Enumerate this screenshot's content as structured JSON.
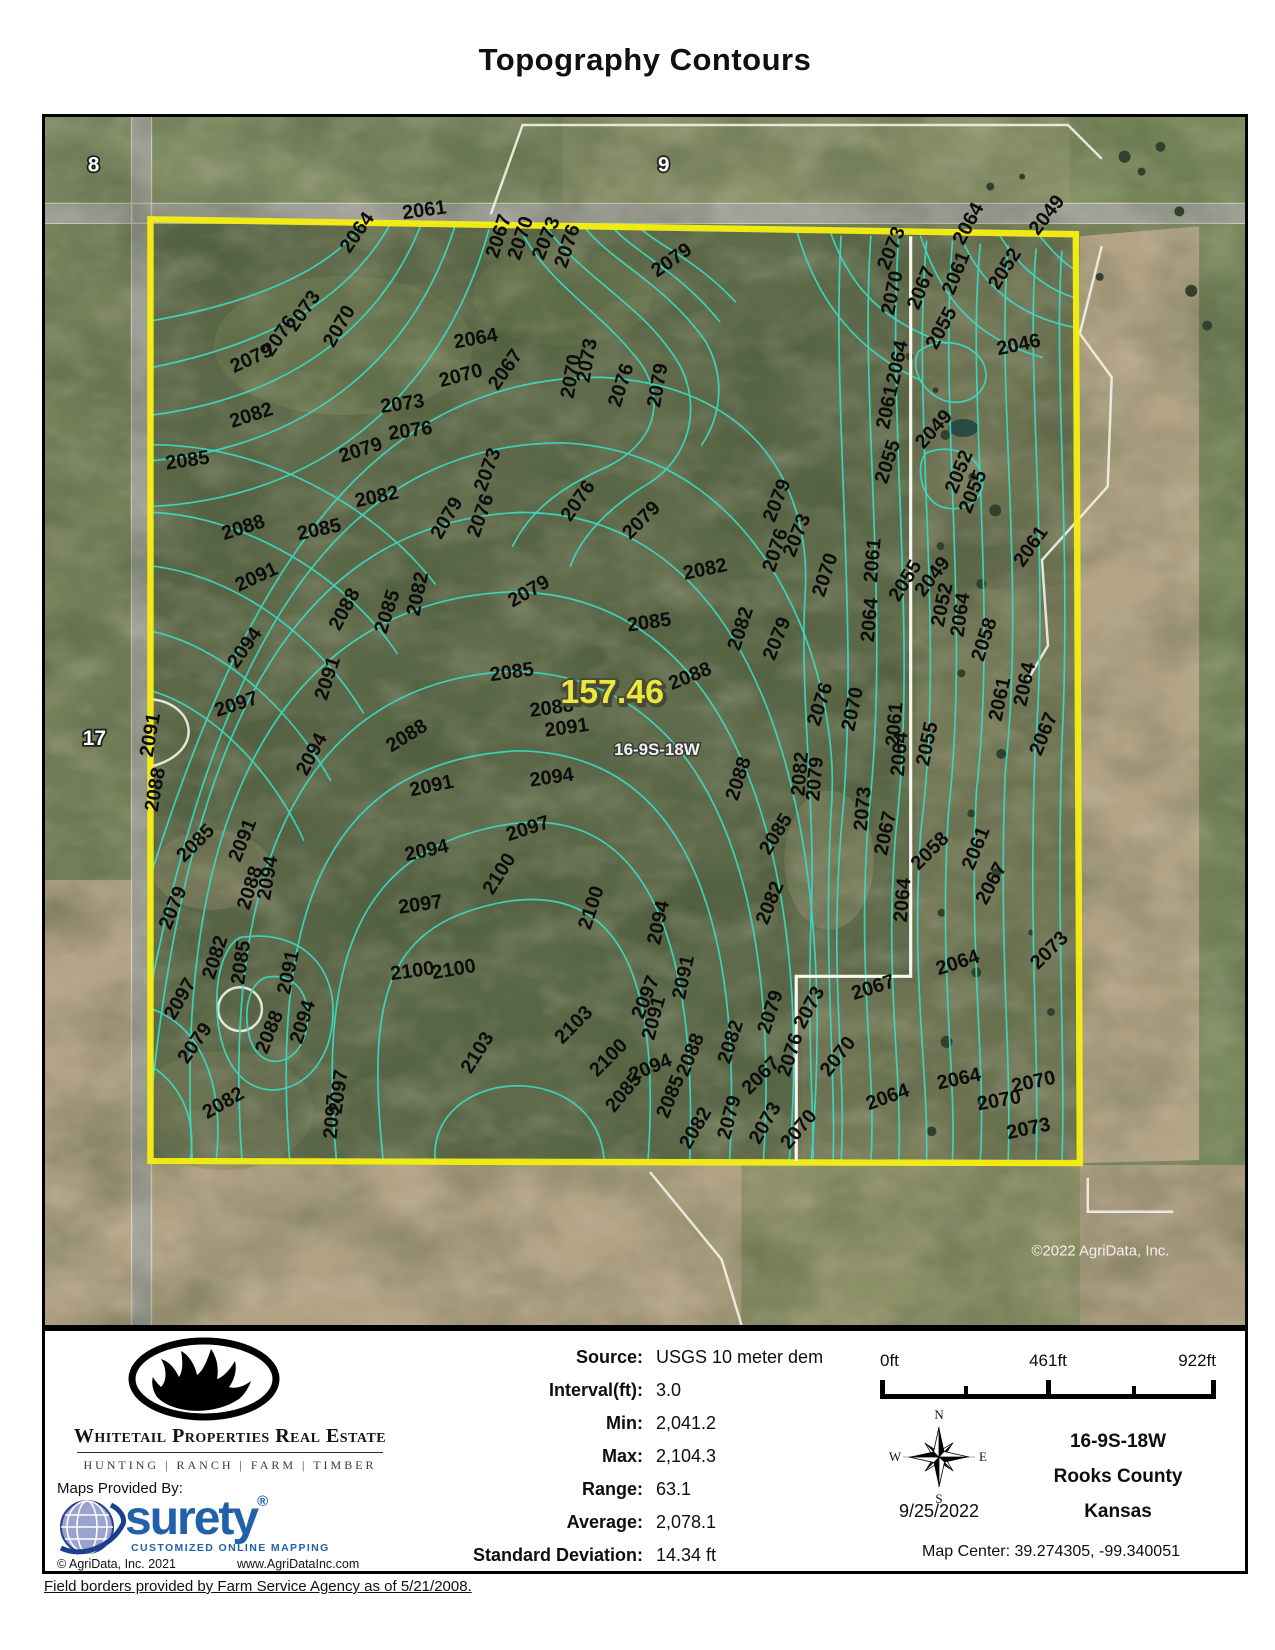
{
  "title": "Topography Contours",
  "map": {
    "acreage": "157.46",
    "parcel_label": "16-9S-18W",
    "sections": [
      "8",
      "9",
      "17"
    ],
    "copyright": "©2022 AgriData, Inc.",
    "colors": {
      "boundary": "#f7ef13",
      "contour": "#3bd8c0",
      "acreage_text": "#ece73e",
      "surety_blue": "#2161ab"
    },
    "contour_paths": [
      "M320,106 C290,150 220,185 108,205",
      "M348,106 C310,175 240,225 108,252",
      "M378,108 C340,205 255,280 108,300",
      "M412,110 C372,235 275,330 108,346",
      "M446,114 C405,262 295,382 108,392",
      "M476,110 C505,170 560,195 600,250 C625,290 610,330 565,352 C520,372 488,395 470,432",
      "M502,108 C538,162 602,188 638,250 C660,292 648,342 608,368 C568,392 540,420 528,452",
      "M540,108 C568,146 622,166 664,226 C684,262 680,300 660,330",
      "M566,106 C590,136 636,153 678,206",
      "M592,106 C612,128 652,141 694,186",
      "M108,330 C220,330 330,390 392,470",
      "M108,398 C200,402 300,460 354,540",
      "M108,452 C190,462 272,520 320,600",
      "M108,518 C175,532 245,592 287,668",
      "M108,578 C165,595 227,655 260,728",
      "M392,1051 C385,955 555,945 562,1051",
      "M340,1051 C322,880 345,812 462,790 C585,770 618,880 606,1051",
      "M293,1051 C272,832 325,735 465,712 C615,690 655,852 648,1051",
      "M246,1051 C225,780 295,648 475,638 C658,640 700,835 688,1051",
      "M198,1051 C176,742 268,568 468,558 C682,560 738,802 722,1051",
      "M148,1051 C128,702 238,488 468,478 C700,478 772,762 748,1051",
      "M108,975 C148,602 258,408 478,398 C718,398 800,702 770,1051",
      "M108,868 C178,522 298,330 518,328 C725,335 802,560 790,700 C782,850 795,960 792,1051",
      "M108,758 C208,440 338,262 558,262 C720,270 770,380 764,480 C758,580 775,700 770,800 C766,920 772,990 772,1051",
      "M196,826 C258,816 298,858 288,918 C278,980 218,998 190,958 C164,922 168,840 196,826",
      "M222,866 C254,860 270,888 262,922 C252,958 216,960 206,928 C198,898 206,872 222,866",
      "M108,898 C160,918 180,978 172,1051",
      "M108,956 C140,978 152,1012 146,1051",
      "M800,120 C790,300 820,520 800,720 C788,870 806,960 800,1051",
      "M830,120 C818,280 850,500 828,700 C815,860 836,960 830,1051",
      "M858,120 C845,300 878,520 855,720 C843,870 862,960 858,1051",
      "M886,125 C870,300 906,520 880,720 C870,870 888,960 886,1051",
      "M912,125 C898,300 930,500 908,700 C898,860 916,960 912,1051",
      "M940,128 C925,280 958,480 936,680 C928,850 946,950 940,1051",
      "M968,130 C955,280 986,460 965,660 C958,840 972,950 968,1051",
      "M996,133 C985,260 1010,440 995,640 C988,830 1000,950 996,1051",
      "M1022,135 C1013,250 1032,430 1022,630 C1016,820 1026,950 1022,1051",
      "M790,118 C810,172 842,206 906,228",
      "M756,116 C776,186 816,236 882,266",
      "M880,120 C900,180 932,222 1002,242",
      "M920,120 C942,172 982,202 1036,212",
      "M960,120 C982,156 1012,176 1036,182",
      "M1000,120 C1016,140 1028,150 1036,154",
      "M878,236 C898,220 934,226 944,250 C952,274 930,292 906,286 C884,280 868,254 878,236",
      "M886,338 C910,328 938,340 942,362 C946,386 922,400 900,392 C880,384 874,350 886,338"
    ],
    "contour_labels": [
      {
        "t": "2061",
        "x": 360,
        "y": 103,
        "r": -8
      },
      {
        "t": "2064",
        "x": 306,
        "y": 138,
        "r": -55
      },
      {
        "t": "2067",
        "x": 455,
        "y": 143,
        "r": -72
      },
      {
        "t": "2070",
        "x": 477,
        "y": 145,
        "r": -72
      },
      {
        "t": "2073",
        "x": 501,
        "y": 145,
        "r": -68
      },
      {
        "t": "2076",
        "x": 524,
        "y": 153,
        "r": -72
      },
      {
        "t": "2079",
        "x": 615,
        "y": 162,
        "r": -35
      },
      {
        "t": "2073",
        "x": 252,
        "y": 217,
        "r": -55
      },
      {
        "t": "2076",
        "x": 228,
        "y": 242,
        "r": -55
      },
      {
        "t": "2079",
        "x": 190,
        "y": 258,
        "r": -25
      },
      {
        "t": "2070",
        "x": 290,
        "y": 233,
        "r": -60
      },
      {
        "t": "2064",
        "x": 412,
        "y": 233,
        "r": -10
      },
      {
        "t": "2070",
        "x": 398,
        "y": 272,
        "r": -15
      },
      {
        "t": "2067",
        "x": 455,
        "y": 276,
        "r": -55
      },
      {
        "t": "2073",
        "x": 547,
        "y": 268,
        "r": -80
      },
      {
        "t": "2070",
        "x": 531,
        "y": 284,
        "r": -80
      },
      {
        "t": "2076",
        "x": 578,
        "y": 293,
        "r": -72
      },
      {
        "t": "2079",
        "x": 618,
        "y": 293,
        "r": -80
      },
      {
        "t": "2082",
        "x": 188,
        "y": 313,
        "r": -18
      },
      {
        "t": "2073",
        "x": 338,
        "y": 298,
        "r": -8
      },
      {
        "t": "2076",
        "x": 346,
        "y": 325,
        "r": -8
      },
      {
        "t": "2079",
        "x": 298,
        "y": 348,
        "r": -18
      },
      {
        "t": "2085",
        "x": 122,
        "y": 355,
        "r": -8
      },
      {
        "t": "2082",
        "x": 313,
        "y": 393,
        "r": -12
      },
      {
        "t": "2073",
        "x": 443,
        "y": 378,
        "r": -70
      },
      {
        "t": "2076",
        "x": 436,
        "y": 424,
        "r": -70
      },
      {
        "t": "2079",
        "x": 398,
        "y": 426,
        "r": -60
      },
      {
        "t": "2088",
        "x": 180,
        "y": 426,
        "r": -18
      },
      {
        "t": "2085",
        "x": 255,
        "y": 426,
        "r": -12
      },
      {
        "t": "2076",
        "x": 528,
        "y": 408,
        "r": -55
      },
      {
        "t": "2079",
        "x": 588,
        "y": 426,
        "r": -45
      },
      {
        "t": "2091",
        "x": 195,
        "y": 478,
        "r": -25
      },
      {
        "t": "2082",
        "x": 643,
        "y": 466,
        "r": -12
      },
      {
        "t": "2079",
        "x": 470,
        "y": 494,
        "r": -30
      },
      {
        "t": "2085",
        "x": 586,
        "y": 518,
        "r": -8
      },
      {
        "t": "2082",
        "x": 376,
        "y": 503,
        "r": -78
      },
      {
        "t": "2085",
        "x": 343,
        "y": 521,
        "r": -72
      },
      {
        "t": "2088",
        "x": 296,
        "y": 518,
        "r": -62
      },
      {
        "t": "2094",
        "x": 193,
        "y": 556,
        "r": -55
      },
      {
        "t": "2091",
        "x": 283,
        "y": 588,
        "r": -72
      },
      {
        "t": "2097",
        "x": 173,
        "y": 604,
        "r": -18
      },
      {
        "t": "2085",
        "x": 448,
        "y": 568,
        "r": -8
      },
      {
        "t": "2082",
        "x": 698,
        "y": 538,
        "r": -72
      },
      {
        "t": "2088",
        "x": 630,
        "y": 577,
        "r": -22
      },
      {
        "t": "2079",
        "x": 733,
        "y": 548,
        "r": -68
      },
      {
        "t": "2091",
        "x": 108,
        "y": 645,
        "r": -80
      },
      {
        "t": "2088",
        "x": 113,
        "y": 700,
        "r": -80
      },
      {
        "t": "2094",
        "x": 263,
        "y": 664,
        "r": -62
      },
      {
        "t": "2088",
        "x": 348,
        "y": 640,
        "r": -32
      },
      {
        "t": "2091",
        "x": 368,
        "y": 684,
        "r": -12
      },
      {
        "t": "2088",
        "x": 488,
        "y": 604,
        "r": -8
      },
      {
        "t": "2091",
        "x": 503,
        "y": 624,
        "r": -8
      },
      {
        "t": "2094",
        "x": 488,
        "y": 674,
        "r": -8
      },
      {
        "t": "2097",
        "x": 466,
        "y": 729,
        "r": -18
      },
      {
        "t": "2094",
        "x": 363,
        "y": 749,
        "r": -12
      },
      {
        "t": "2100",
        "x": 450,
        "y": 784,
        "r": -58
      },
      {
        "t": "2097",
        "x": 356,
        "y": 802,
        "r": -8
      },
      {
        "t": "2085",
        "x": 140,
        "y": 751,
        "r": -45
      },
      {
        "t": "2091",
        "x": 196,
        "y": 751,
        "r": -68
      },
      {
        "t": "2088",
        "x": 205,
        "y": 799,
        "r": -72
      },
      {
        "t": "2094",
        "x": 226,
        "y": 789,
        "r": -80
      },
      {
        "t": "2079",
        "x": 126,
        "y": 819,
        "r": -68
      },
      {
        "t": "2082",
        "x": 170,
        "y": 869,
        "r": -72
      },
      {
        "t": "2085",
        "x": 200,
        "y": 874,
        "r": -82
      },
      {
        "t": "2091",
        "x": 246,
        "y": 884,
        "r": -78
      },
      {
        "t": "2094",
        "x": 258,
        "y": 934,
        "r": -72
      },
      {
        "t": "2088",
        "x": 223,
        "y": 944,
        "r": -68
      },
      {
        "t": "2079",
        "x": 143,
        "y": 954,
        "r": -55
      },
      {
        "t": "2082",
        "x": 163,
        "y": 1009,
        "r": -30
      },
      {
        "t": "2097",
        "x": 298,
        "y": 1004,
        "r": -82
      },
      {
        "t": "2100",
        "x": 348,
        "y": 869,
        "r": -8
      },
      {
        "t": "2103",
        "x": 428,
        "y": 964,
        "r": -58
      },
      {
        "t": "2100",
        "x": 548,
        "y": 819,
        "r": -72
      },
      {
        "t": "2103",
        "x": 520,
        "y": 934,
        "r": -45
      },
      {
        "t": "2100",
        "x": 555,
        "y": 967,
        "r": -45
      },
      {
        "t": "2094",
        "x": 590,
        "y": 971,
        "r": -22
      },
      {
        "t": "2097",
        "x": 601,
        "y": 909,
        "r": -68
      },
      {
        "t": "2094",
        "x": 618,
        "y": 834,
        "r": -78
      },
      {
        "t": "2091",
        "x": 643,
        "y": 889,
        "r": -78
      },
      {
        "t": "2088",
        "x": 646,
        "y": 967,
        "r": -68
      },
      {
        "t": "2085",
        "x": 626,
        "y": 1009,
        "r": -68
      },
      {
        "t": "2082",
        "x": 688,
        "y": 954,
        "r": -72
      },
      {
        "t": "2088",
        "x": 696,
        "y": 689,
        "r": -72
      },
      {
        "t": "2085",
        "x": 728,
        "y": 744,
        "r": -58
      },
      {
        "t": "2082",
        "x": 726,
        "y": 814,
        "r": -68
      },
      {
        "t": "2079",
        "x": 728,
        "y": 924,
        "r": -72
      },
      {
        "t": "2076",
        "x": 748,
        "y": 967,
        "r": -72
      },
      {
        "t": "2073",
        "x": 763,
        "y": 919,
        "r": -62
      },
      {
        "t": "2070",
        "x": 788,
        "y": 967,
        "r": -52
      },
      {
        "t": "2067",
        "x": 813,
        "y": 889,
        "r": -18
      },
      {
        "t": "2064",
        "x": 898,
        "y": 864,
        "r": -18
      },
      {
        "t": "2064",
        "x": 898,
        "y": 979,
        "r": -12
      },
      {
        "t": "2070",
        "x": 973,
        "y": 982,
        "r": -12
      },
      {
        "t": "2073",
        "x": 998,
        "y": 859,
        "r": -45
      },
      {
        "t": "2073",
        "x": 968,
        "y": 1029,
        "r": -12
      },
      {
        "t": "2064",
        "x": 923,
        "y": 524,
        "r": -82
      },
      {
        "t": "2058",
        "x": 943,
        "y": 549,
        "r": -72
      },
      {
        "t": "2061",
        "x": 983,
        "y": 454,
        "r": -55
      },
      {
        "t": "2064",
        "x": 986,
        "y": 594,
        "r": -78
      },
      {
        "t": "2061",
        "x": 961,
        "y": 609,
        "r": -78
      },
      {
        "t": "2067",
        "x": 1001,
        "y": 644,
        "r": -68
      },
      {
        "t": "2061",
        "x": 933,
        "y": 759,
        "r": -68
      },
      {
        "t": "2067",
        "x": 946,
        "y": 794,
        "r": -62
      },
      {
        "t": "2064",
        "x": 866,
        "y": 811,
        "r": -85
      },
      {
        "t": "2058",
        "x": 878,
        "y": 759,
        "r": -45
      },
      {
        "t": "2061",
        "x": 858,
        "y": 634,
        "r": -85
      },
      {
        "t": "2064",
        "x": 863,
        "y": 664,
        "r": -85
      },
      {
        "t": "2055",
        "x": 888,
        "y": 654,
        "r": -78
      },
      {
        "t": "2070",
        "x": 813,
        "y": 619,
        "r": -78
      },
      {
        "t": "2073",
        "x": 826,
        "y": 719,
        "r": -85
      },
      {
        "t": "2067",
        "x": 846,
        "y": 744,
        "r": -78
      },
      {
        "t": "2076",
        "x": 778,
        "y": 614,
        "r": -72
      },
      {
        "t": "2079",
        "x": 778,
        "y": 689,
        "r": -85
      },
      {
        "t": "2082",
        "x": 763,
        "y": 684,
        "r": -85
      },
      {
        "t": "2079",
        "x": 733,
        "y": 409,
        "r": -68
      },
      {
        "t": "2076",
        "x": 733,
        "y": 459,
        "r": -72
      },
      {
        "t": "2073",
        "x": 753,
        "y": 444,
        "r": -68
      },
      {
        "t": "2070",
        "x": 783,
        "y": 484,
        "r": -72
      },
      {
        "t": "2061",
        "x": 836,
        "y": 469,
        "r": -85
      },
      {
        "t": "2055",
        "x": 858,
        "y": 489,
        "r": -58
      },
      {
        "t": "2049",
        "x": 883,
        "y": 484,
        "r": -52
      },
      {
        "t": "2052",
        "x": 903,
        "y": 514,
        "r": -78
      },
      {
        "t": "2064",
        "x": 833,
        "y": 529,
        "r": -85
      },
      {
        "t": "2073",
        "x": 848,
        "y": 155,
        "r": -68
      },
      {
        "t": "2070",
        "x": 853,
        "y": 200,
        "r": -78
      },
      {
        "t": "2067",
        "x": 878,
        "y": 195,
        "r": -68
      },
      {
        "t": "2061",
        "x": 913,
        "y": 180,
        "r": -68
      },
      {
        "t": "2064",
        "x": 923,
        "y": 130,
        "r": -62
      },
      {
        "t": "2052",
        "x": 958,
        "y": 175,
        "r": -58
      },
      {
        "t": "2049",
        "x": 998,
        "y": 120,
        "r": -52
      },
      {
        "t": "2046",
        "x": 958,
        "y": 240,
        "r": -12
      },
      {
        "t": "2055",
        "x": 896,
        "y": 235,
        "r": -62
      },
      {
        "t": "2064",
        "x": 858,
        "y": 270,
        "r": -78
      },
      {
        "t": "2061",
        "x": 848,
        "y": 315,
        "r": -78
      },
      {
        "t": "2055",
        "x": 846,
        "y": 370,
        "r": -72
      },
      {
        "t": "2049",
        "x": 883,
        "y": 335,
        "r": -48
      },
      {
        "t": "2052",
        "x": 916,
        "y": 380,
        "r": -68
      },
      {
        "t": "2055",
        "x": 930,
        "y": 400,
        "r": -68
      },
      {
        "t": "2097",
        "x": 293,
        "y": 1029,
        "r": -85
      },
      {
        "t": "2085",
        "x": 572,
        "y": 1003,
        "r": -50
      },
      {
        "t": "2091",
        "x": 612,
        "y": 930,
        "r": -75
      },
      {
        "t": "2082",
        "x": 648,
        "y": 1040,
        "r": -60
      },
      {
        "t": "2079",
        "x": 688,
        "y": 1030,
        "r": -75
      },
      {
        "t": "2073",
        "x": 718,
        "y": 1035,
        "r": -60
      },
      {
        "t": "2070",
        "x": 748,
        "y": 1040,
        "r": -50
      },
      {
        "t": "2067",
        "x": 708,
        "y": 985,
        "r": -45
      },
      {
        "t": "2064",
        "x": 828,
        "y": 1000,
        "r": -20
      },
      {
        "t": "2070",
        "x": 938,
        "y": 1000,
        "r": -10
      },
      {
        "t": "2097",
        "x": 130,
        "y": 910,
        "r": -60
      },
      {
        "t": "2100",
        "x": 390,
        "y": 868,
        "r": -10
      }
    ]
  },
  "stats": {
    "rows": [
      {
        "label": "Source:",
        "value": "USGS 10 meter dem"
      },
      {
        "label": "Interval(ft):",
        "value": "3.0"
      },
      {
        "label": "Min:",
        "value": "2,041.2"
      },
      {
        "label": "Max:",
        "value": "2,104.3"
      },
      {
        "label": "Range:",
        "value": "63.1"
      },
      {
        "label": "Average:",
        "value": "2,078.1"
      },
      {
        "label": "Standard Deviation:",
        "value": "14.34 ft"
      }
    ]
  },
  "scalebar": {
    "labels": [
      "0ft",
      "461ft",
      "922ft"
    ]
  },
  "compass": {
    "n": "N",
    "e": "E",
    "s": "S",
    "w": "W",
    "date": "9/25/2022"
  },
  "location": {
    "parcel": "16-9S-18W",
    "county": "Rooks County",
    "state": "Kansas",
    "map_center": "Map Center: 39.274305, -99.340051"
  },
  "branding": {
    "company": "Whitetail Properties Real Estate",
    "tagline": "HUNTING | RANCH | FARM | TIMBER",
    "maps_provided_by": "Maps Provided By:",
    "surety_name": "surety",
    "surety_reg": "®",
    "surety_tagline": "CUSTOMIZED ONLINE MAPPING",
    "surety_copyright": "© AgriData, Inc. 2021",
    "surety_website": "www.AgriDataInc.com"
  },
  "footer": "Field borders provided by Farm Service Agency as of 5/21/2008."
}
